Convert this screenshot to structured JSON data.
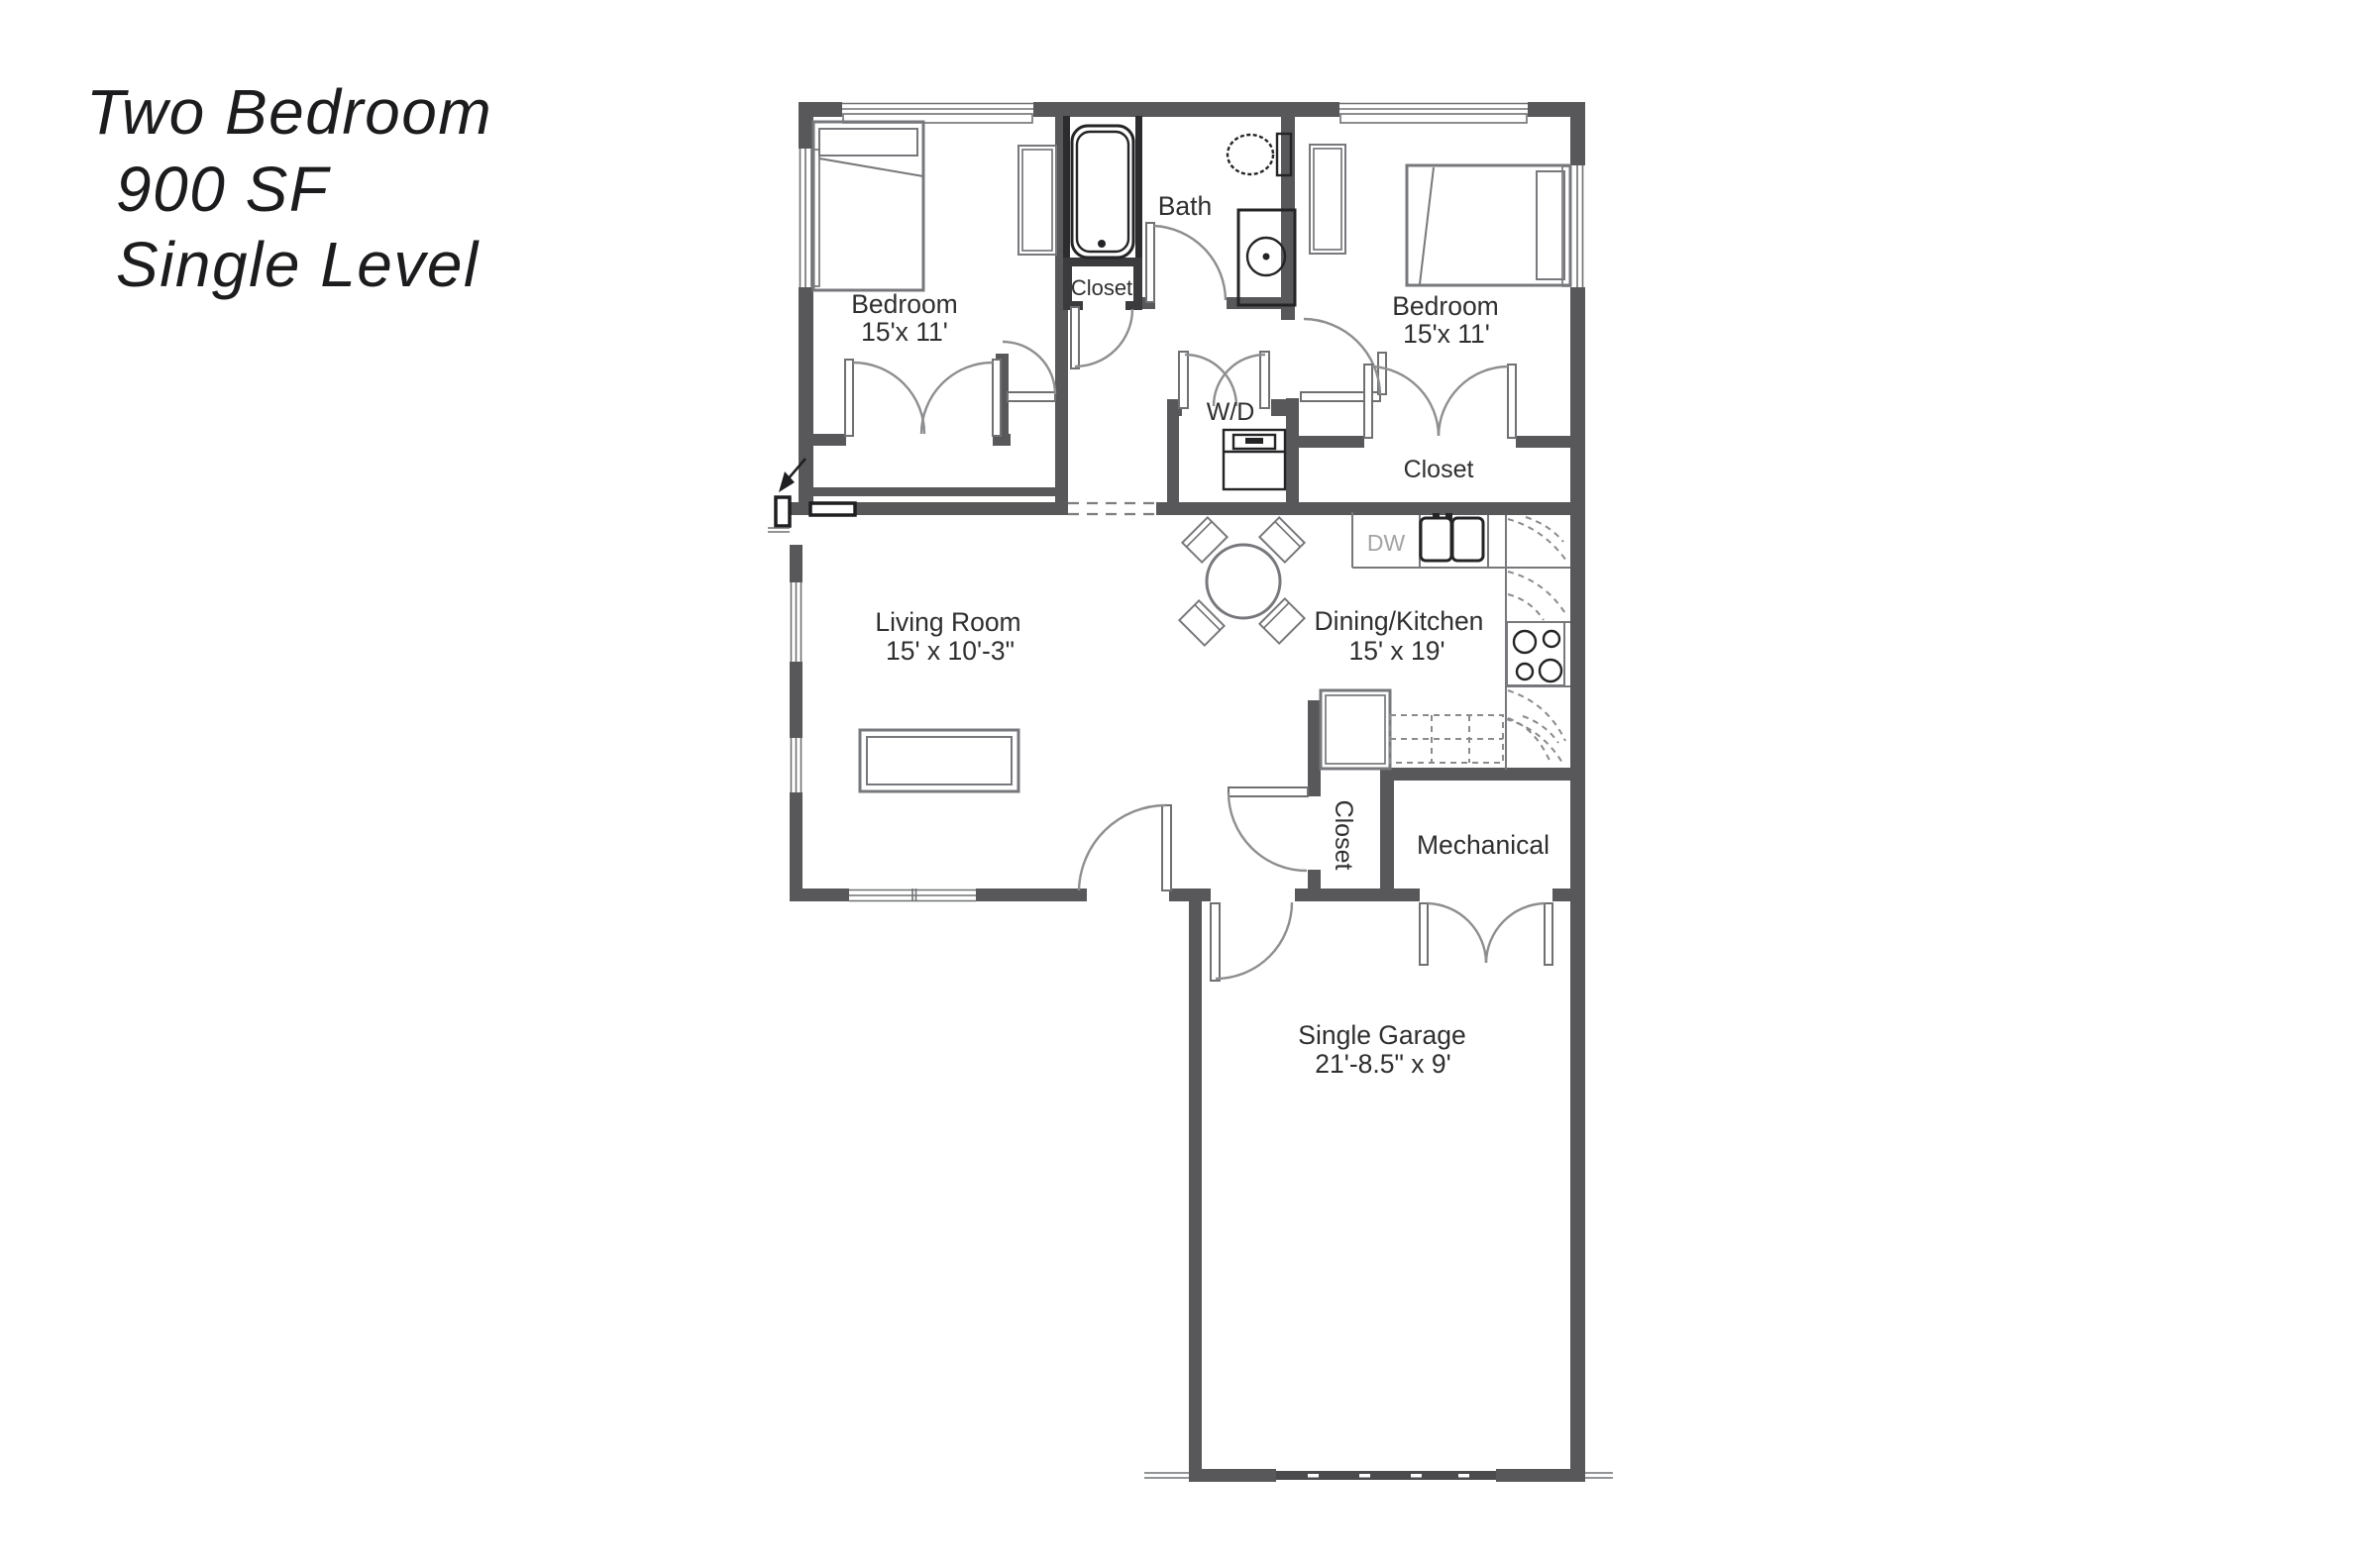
{
  "title": {
    "line1": "Two Bedroom",
    "line2": "900 SF",
    "line3": "Single Level"
  },
  "rooms": {
    "bedroom_left": {
      "name": "Bedroom",
      "dims": "15'x 11'"
    },
    "bedroom_right": {
      "name": "Bedroom",
      "dims": "15'x 11'"
    },
    "bath": {
      "name": "Bath"
    },
    "hall_closet": {
      "name": "Closet"
    },
    "bedroom_right_closet": {
      "name": "Closet"
    },
    "entry_closet": {
      "name": "Closet"
    },
    "laundry": {
      "name": "W/D"
    },
    "living_room": {
      "name": "Living Room",
      "dims": "15' x 10'-3\""
    },
    "dining_kitchen": {
      "name": "Dining/Kitchen",
      "dims": "15' x 19'"
    },
    "mechanical": {
      "name": "Mechanical"
    },
    "garage": {
      "name": "Single Garage",
      "dims": "21'-8.5\" x 9'"
    }
  },
  "appliances": {
    "dishwasher": "DW"
  },
  "colors": {
    "wall": "#58585b",
    "fixture": "#242426",
    "text": "#2f2f31",
    "muted": "#a4a4a6"
  }
}
